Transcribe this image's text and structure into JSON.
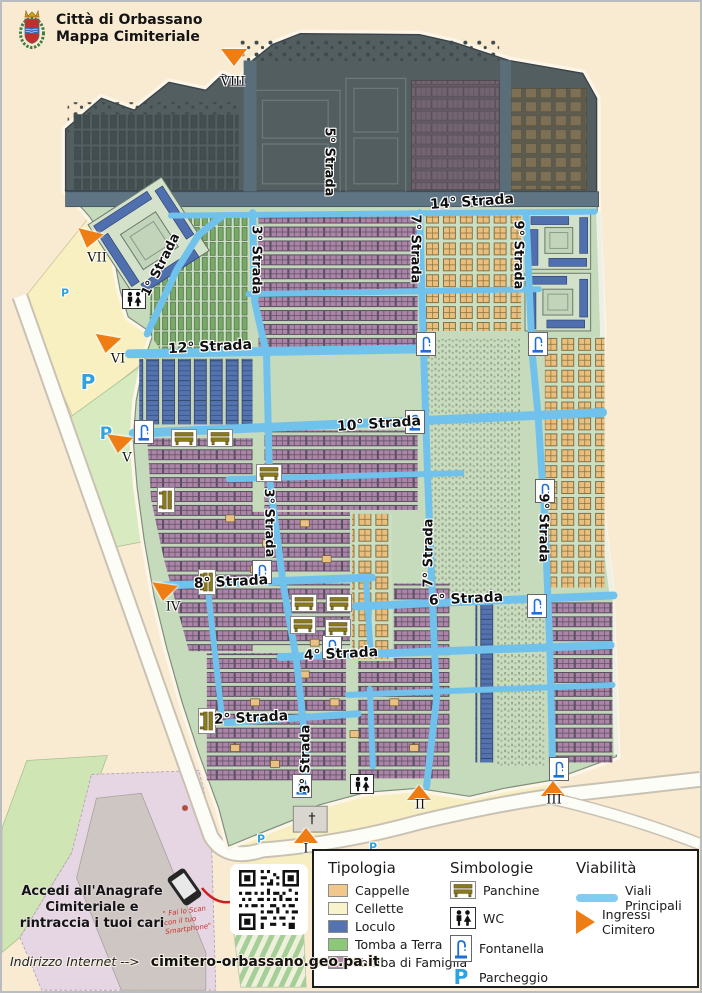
{
  "header": {
    "title_line1": "Città di Orbassano",
    "title_line2": "Mappa Cimiteriale"
  },
  "map": {
    "street_labels": [
      {
        "text": "5° Strada"
      },
      {
        "text": "14° Strada"
      },
      {
        "text": "3° Strada"
      },
      {
        "text": "7° Strada"
      },
      {
        "text": "9° Strada"
      },
      {
        "text": "1° Strada"
      },
      {
        "text": "12° Strada"
      },
      {
        "text": "10° Strada"
      },
      {
        "text": "3° Strada"
      },
      {
        "text": "7° Strada"
      },
      {
        "text": "9° Strada"
      },
      {
        "text": "8° Strada"
      },
      {
        "text": "6° Strada"
      },
      {
        "text": "4° Strada"
      },
      {
        "text": "2° Strada"
      },
      {
        "text": "3° Strada"
      }
    ],
    "entrances": [
      {
        "numeral": "VIII"
      },
      {
        "numeral": "VII"
      },
      {
        "numeral": "VI"
      },
      {
        "numeral": "V"
      },
      {
        "numeral": "IV"
      },
      {
        "numeral": "I"
      },
      {
        "numeral": "II"
      },
      {
        "numeral": "III"
      }
    ],
    "parking_letter": "P",
    "church_cross": "†"
  },
  "legend": {
    "tipologia": {
      "title": "Tipologia",
      "items": [
        {
          "label": "Cappelle",
          "color": "#f2c78b"
        },
        {
          "label": "Cellette",
          "color": "#f7f3cc"
        },
        {
          "label": "Loculo",
          "color": "#5573b1"
        },
        {
          "label": "Tomba a Terra",
          "color": "#8cc878"
        },
        {
          "label": "Tomba di Famiglia",
          "color": "#b28cac"
        }
      ]
    },
    "simbologie": {
      "title": "Simbologie",
      "items": [
        {
          "label": "Panchine",
          "icon": "bench-icon"
        },
        {
          "label": "WC",
          "icon": "wc-icon"
        },
        {
          "label": "Fontanella",
          "icon": "fountain-icon"
        },
        {
          "label": "Parcheggio",
          "icon": "parking-icon"
        }
      ]
    },
    "viabilita": {
      "title": "Viabilità",
      "items": [
        {
          "label": "Viali Principali",
          "icon": "main-road-line"
        },
        {
          "label": "Ingressi Cimitero",
          "icon": "entrance-triangle"
        }
      ]
    }
  },
  "info": {
    "anagrafe_line1": "Accedi all'Anagrafe",
    "anagrafe_line2": "Cimiteriale e",
    "anagrafe_line3": "rintraccia i tuoi cari",
    "qr_note_line1": "\" Fai lo Scan",
    "qr_note_line2": "con il tuo",
    "qr_note_line3": "Smartphone\"",
    "footer_label": "Indirizzo Internet -->",
    "footer_url": "cimitero-orbassano.geo.pa.it"
  },
  "colors": {
    "page_background": "#f9ead2",
    "cemetery_green": "#c6dabc",
    "dark_zone": "#535e60",
    "street_blue": "#70c2ec",
    "entrance_orange": "#ee7d14",
    "parking_blue": "#2fa3e0",
    "cappelle": "#e9bf80",
    "loculo": "#5372ae",
    "tomba_famiglia": "#ab84a8",
    "tomba_terra": "#79a967"
  }
}
